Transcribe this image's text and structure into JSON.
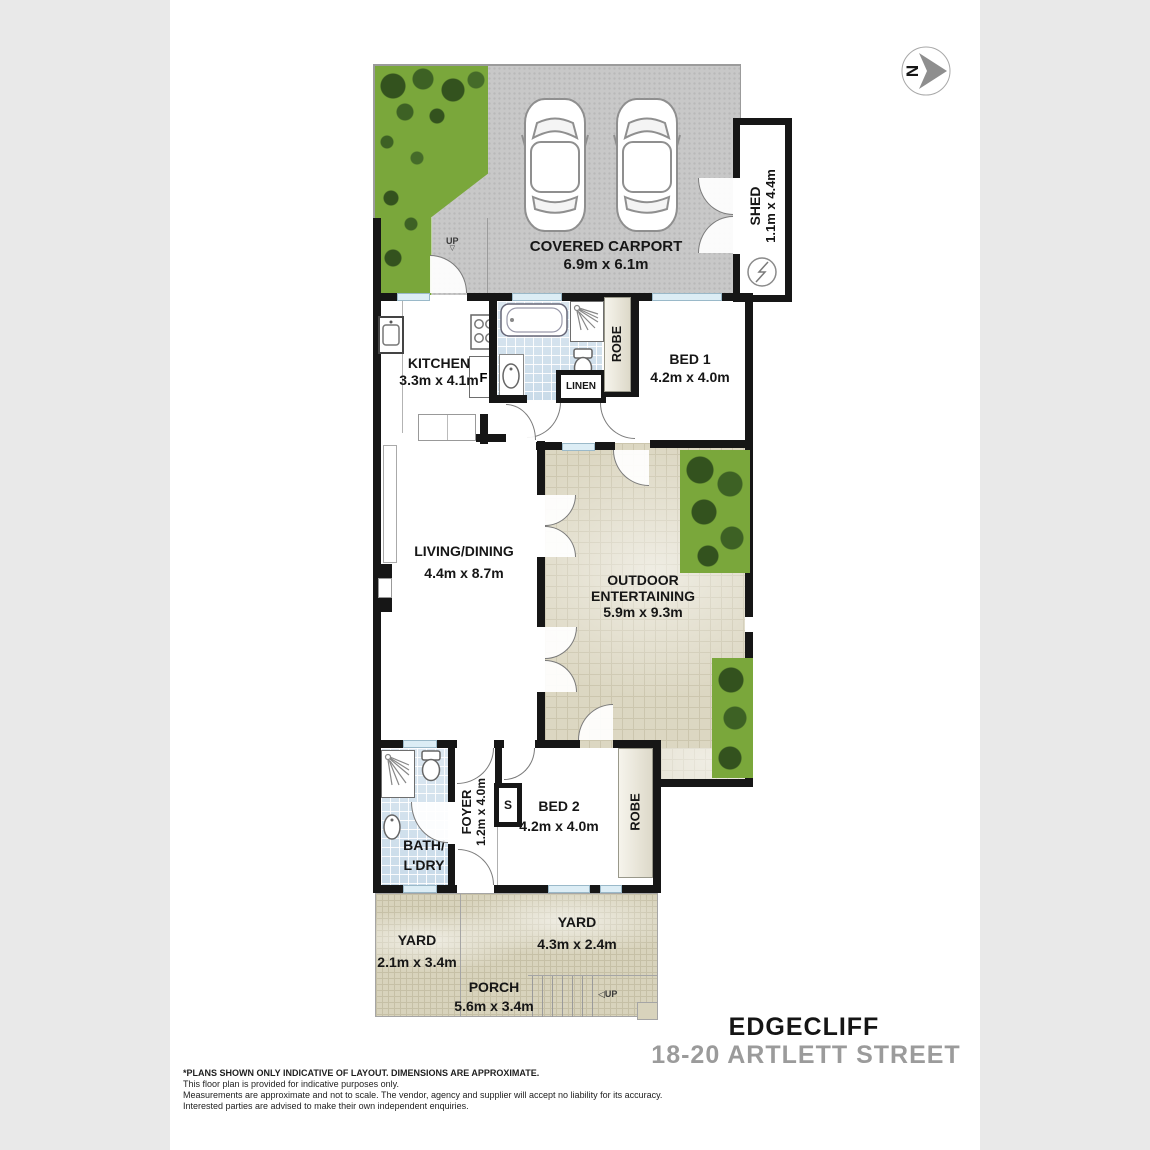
{
  "compass": {
    "north_letter": "N"
  },
  "rooms": {
    "carport": {
      "name": "COVERED CARPORT",
      "dims": "6.9m x 6.1m"
    },
    "shed": {
      "name": "SHED",
      "dims": "1.1m x 4.4m"
    },
    "kitchen": {
      "name": "KITCHEN",
      "dims": "3.3m x 4.1m"
    },
    "bed1": {
      "name": "BED 1",
      "dims": "4.2m x 4.0m"
    },
    "robe1": {
      "name": "ROBE"
    },
    "linen": {
      "name": "LINEN"
    },
    "living": {
      "name": "LIVING/DINING",
      "dims": "4.4m x 8.7m"
    },
    "outdoor": {
      "name_line1": "OUTDOOR",
      "name_line2": "ENTERTAINING",
      "dims": "5.9m x 9.3m"
    },
    "foyer": {
      "name": "FOYER",
      "dims": "1.2m x 4.0m"
    },
    "bath_ldry": {
      "name_line1": "BATH/",
      "name_line2": "L'DRY"
    },
    "bed2": {
      "name": "BED 2",
      "dims": "4.2m x 4.0m"
    },
    "robe2": {
      "name": "ROBE"
    },
    "yard_left": {
      "name": "YARD",
      "dims": "2.1m x 3.4m"
    },
    "yard_right": {
      "name": "YARD",
      "dims": "4.3m x 2.4m"
    },
    "porch": {
      "name": "PORCH",
      "dims": "5.6m x 3.4m"
    }
  },
  "markers": {
    "up_carport": "UP",
    "up_porch": "UP",
    "fridge": "F",
    "store": "S",
    "up_arrow_down": "▽",
    "up_arrow_left": "◁"
  },
  "title": {
    "suburb": "EDGECLIFF",
    "street": "18-20 ARTLETT STREET"
  },
  "disclaimer": {
    "line1": "*PLANS SHOWN ONLY INDICATIVE OF LAYOUT. DIMENSIONS ARE APPROXIMATE.",
    "line2": "This floor plan is provided for indicative purposes only.",
    "line3": "Measurements are approximate and not to scale. The vendor, agency and supplier will accept no liability for its accuracy.",
    "line4": "Interested parties are advised to make their own independent enquiries."
  },
  "colors": {
    "wall": "#161616",
    "grass": "#7aa73b",
    "paving": "#dcd7c2",
    "bath_tile": "#c9dbe9",
    "concrete": "#c8c8c8",
    "street_title_gray": "#9b9b9b"
  }
}
